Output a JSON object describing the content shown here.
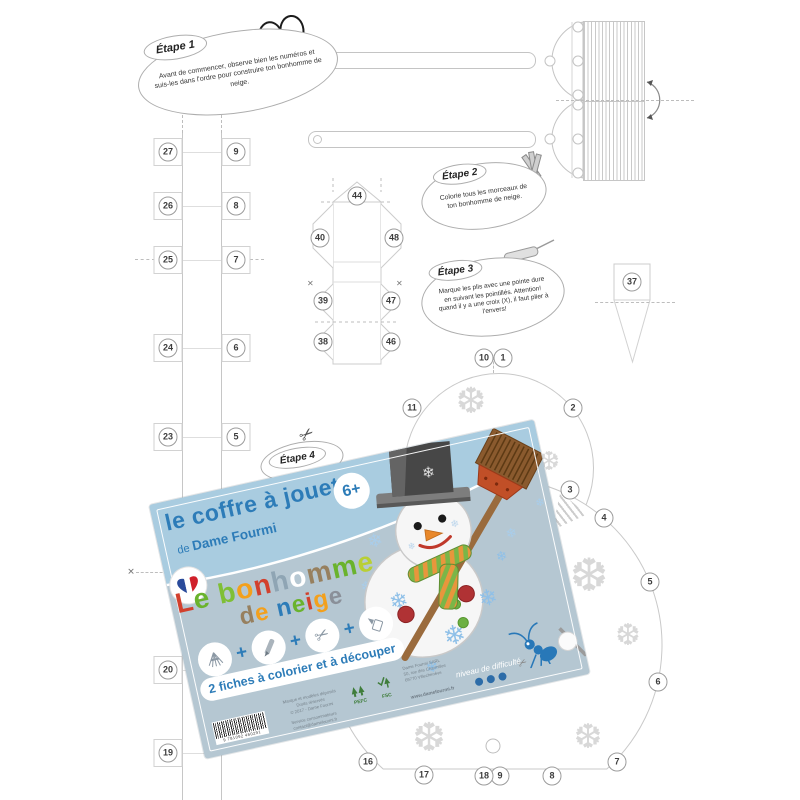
{
  "steps": [
    {
      "label": "Étape 1",
      "text": "Avant de commencer, observe bien les numéros et suis-les dans l'ordre pour construire ton bonhomme de neige."
    },
    {
      "label": "Étape 2",
      "text": "Colorie tous les morceaux de ton bonhomme de neige."
    },
    {
      "label": "Étape 3",
      "text": "Marque les plis avec une pointe dure en suivant les pointillés. Attention! quand il y a une croix (X), il faut plier à l'envers!"
    },
    {
      "label": "Étape 4",
      "text": ""
    }
  ],
  "pieces": {
    "strip_left": [
      "27",
      "26",
      "25",
      "24",
      "23",
      "20",
      "19"
    ],
    "strip_right": [
      "9",
      "8",
      "7",
      "6",
      "5"
    ],
    "box_net": [
      "44",
      "40",
      "48",
      "39",
      "47",
      "38",
      "46"
    ],
    "cone": [
      "37"
    ],
    "head_circle": [
      "10",
      "1",
      "11",
      "2",
      "3"
    ],
    "body_circle": [
      "4",
      "5",
      "6",
      "7",
      "8",
      "9",
      "18",
      "17",
      "16"
    ]
  },
  "card": {
    "header": {
      "title": "le coffre à jouets",
      "subtitle_prefix": "de ",
      "subtitle_name": "Dame Fourmi",
      "age_badge": "6+"
    },
    "title_line1": [
      {
        "ch": "L",
        "c": "#d2402d"
      },
      {
        "ch": "e",
        "c": "#6ab32d"
      },
      {
        "ch": " ",
        "c": "#000000"
      },
      {
        "ch": "b",
        "c": "#7fbf36"
      },
      {
        "ch": "o",
        "c": "#f3a01c"
      },
      {
        "ch": "n",
        "c": "#d2402d"
      },
      {
        "ch": "h",
        "c": "#8fa5b4"
      },
      {
        "ch": "o",
        "c": "#ffffff"
      },
      {
        "ch": "m",
        "c": "#97805f"
      },
      {
        "ch": "m",
        "c": "#6ab32d"
      },
      {
        "ch": "e",
        "c": "#b9cf35"
      }
    ],
    "title_line2": [
      {
        "ch": "d",
        "c": "#97805f"
      },
      {
        "ch": "e",
        "c": "#f3a01c"
      },
      {
        "ch": " ",
        "c": "#000000"
      },
      {
        "ch": "n",
        "c": "#2d7cb8"
      },
      {
        "ch": "e",
        "c": "#6ab32d"
      },
      {
        "ch": "i",
        "c": "#d2402d"
      },
      {
        "ch": "g",
        "c": "#f3a01c"
      },
      {
        "ch": "e",
        "c": "#8a9099"
      }
    ],
    "icons": [
      "paper-sheets",
      "crayon",
      "scissors",
      "glue-tube"
    ],
    "plus_sign": "+",
    "tagline": "2 fiches à colorier et à découper",
    "difficulty": {
      "label": "niveau de difficulté",
      "dots": 3
    },
    "legal": [
      "Marque et modèles déposés",
      "Droits réservés",
      "© 2017 - Dame Fourmi"
    ],
    "service": [
      "Service consommateurs",
      "contact@damefourmi.fr"
    ],
    "address": [
      "Dame Fourmi SARL",
      "50, rue des Charmilles",
      "69770 Villechenève"
    ],
    "website": "www.damefourmi.fr",
    "barcode_digits": "9 781092 460291",
    "logos": {
      "pefc": "PEFC",
      "fsc": "FSC"
    }
  },
  "colors": {
    "card_bg": "#b5c7d2",
    "card_header": "#a9cce0",
    "card_accent": "#2d7cb8",
    "template_line": "#c6c6c6",
    "snowflake_blue": "#9cc3e4",
    "dot_blue": "#2d6ca8"
  }
}
